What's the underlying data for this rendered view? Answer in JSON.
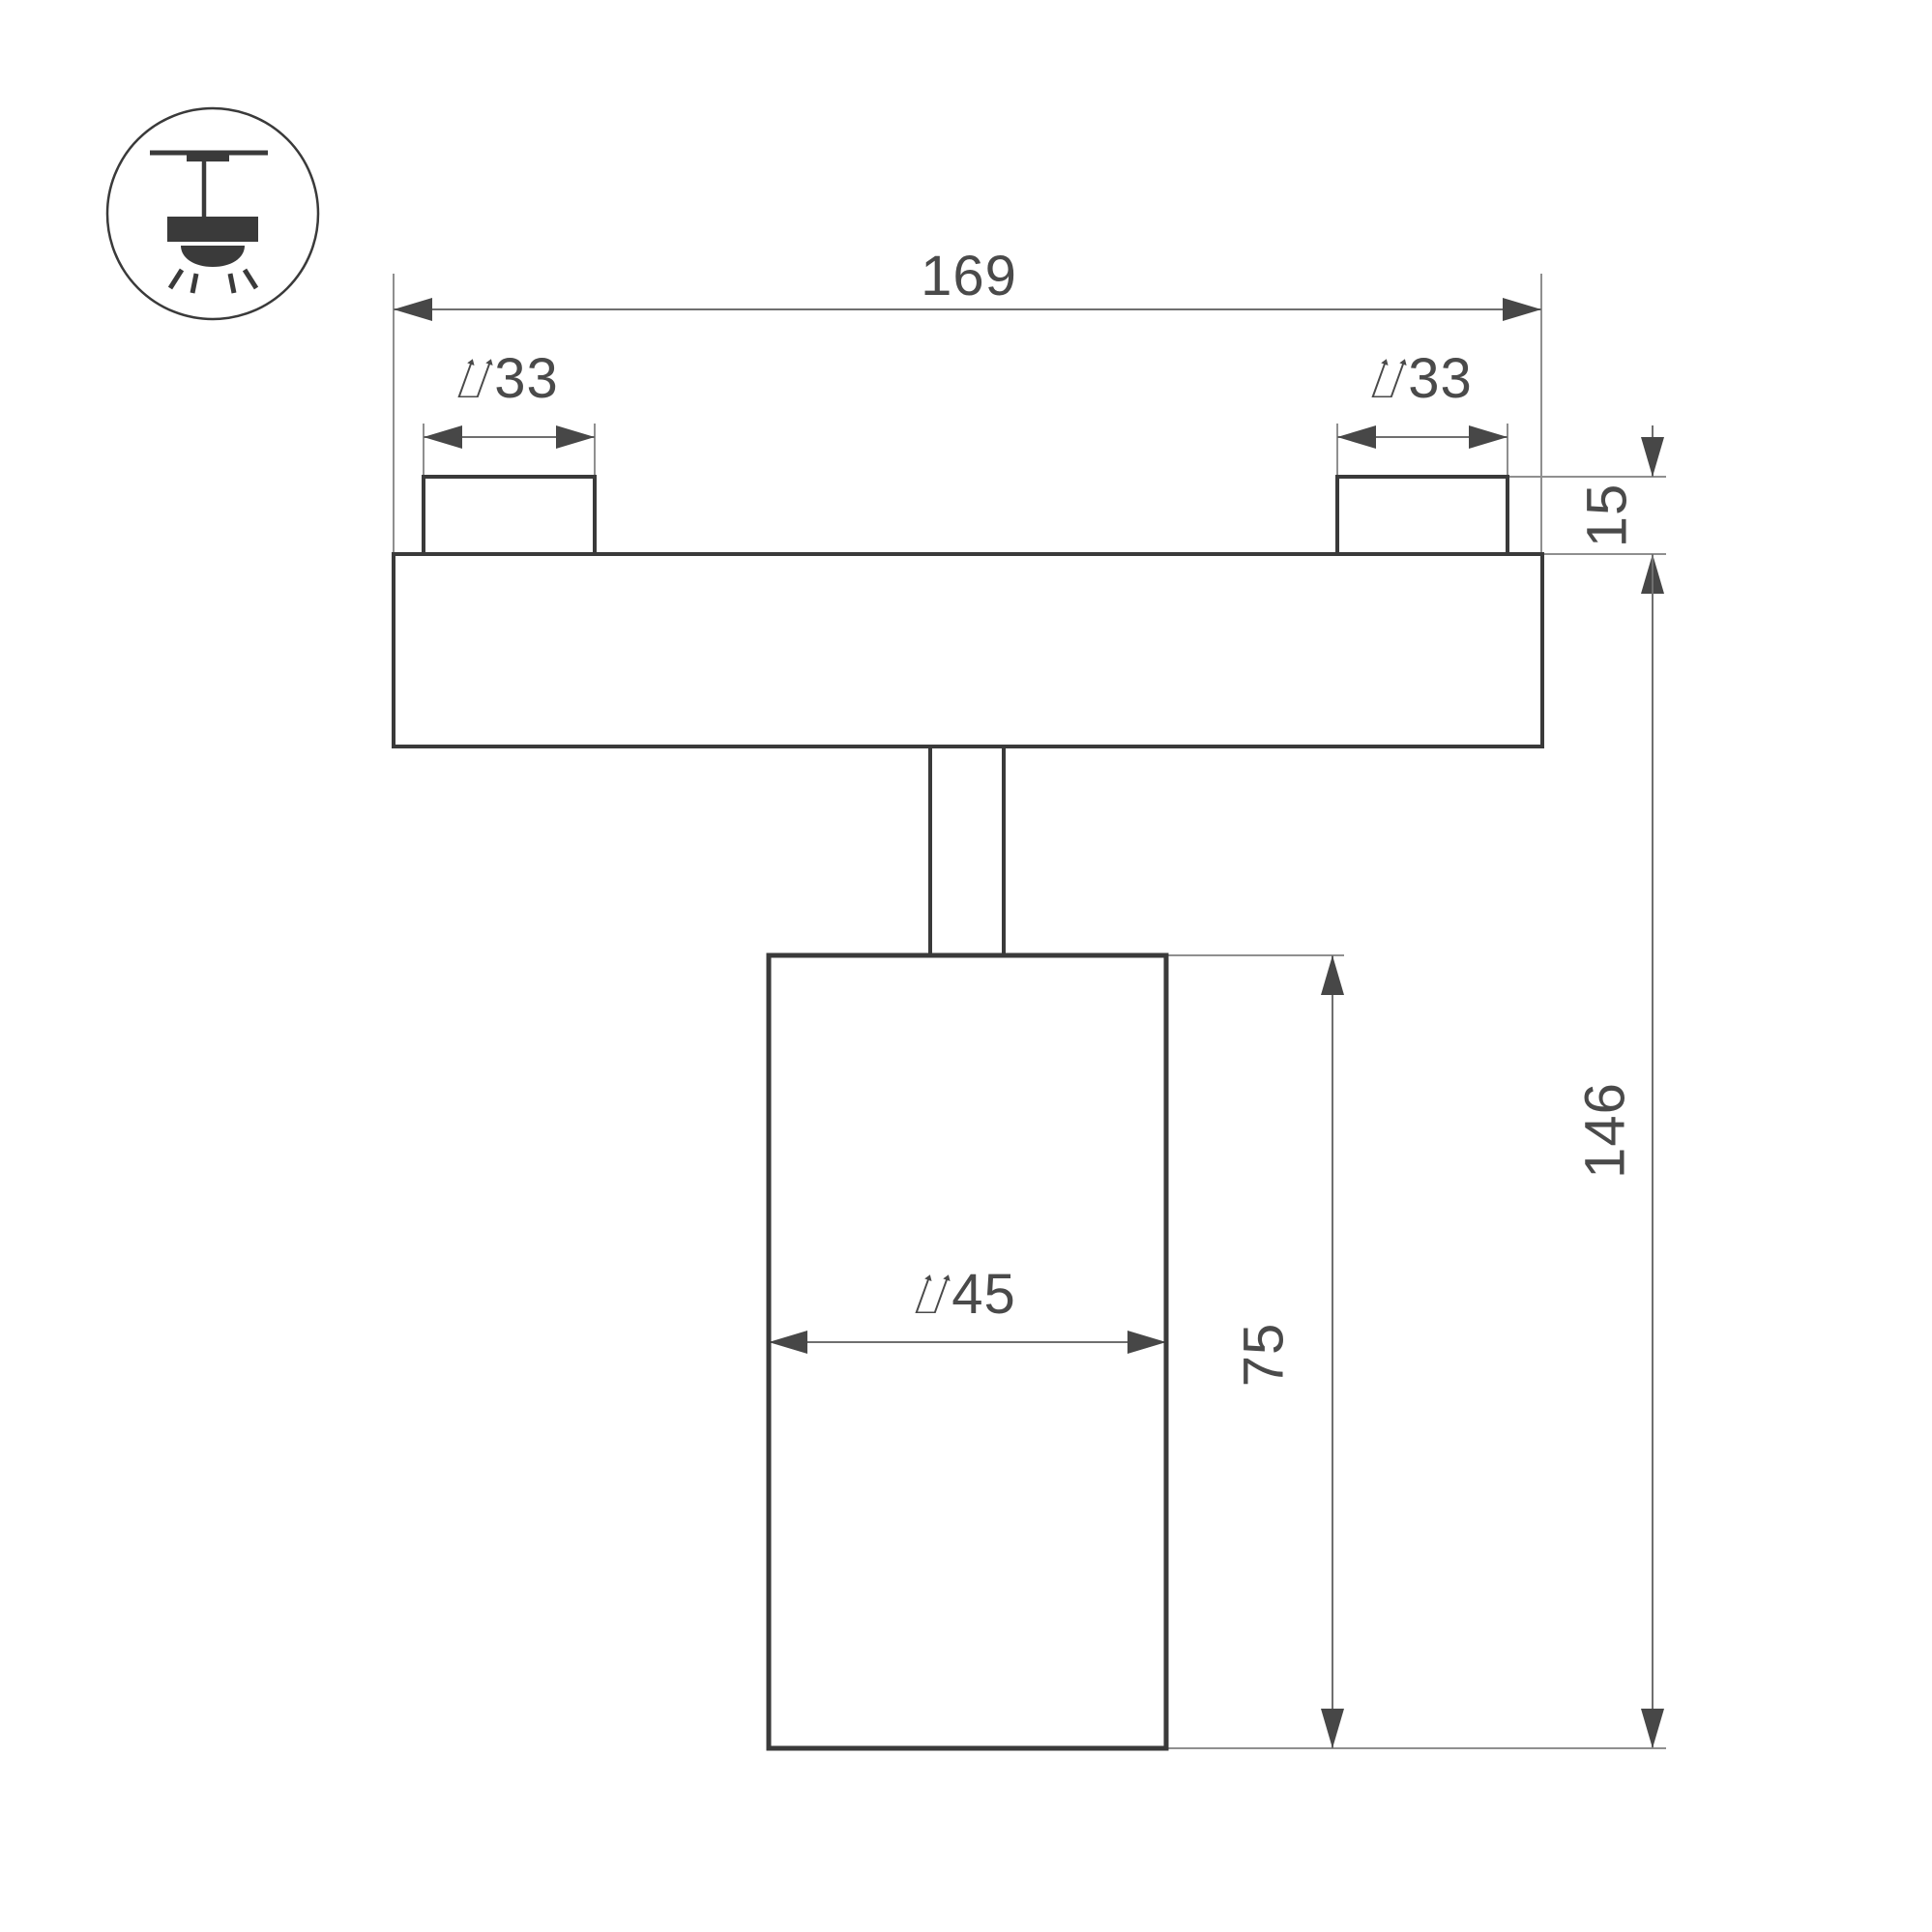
{
  "drawing": {
    "kind": "technical-dimension-drawing",
    "product": "track-mounted spotlight side view",
    "icon": {
      "name": "ceiling-track-pendant-light-icon",
      "description": "circle pictogram: ceiling line with track adapter, stem, lamp body, light dome with rays"
    },
    "dims": {
      "overall_width": {
        "label": "169",
        "value": 169
      },
      "left_connector_diameter": {
        "label": "⌰33",
        "value": 33
      },
      "right_connector_diameter": {
        "label": "⌰33",
        "value": 33
      },
      "connector_height": {
        "label": "15",
        "value": 15
      },
      "body_diameter": {
        "label": "⌰45",
        "value": 45
      },
      "body_height": {
        "label": "75",
        "value": 75
      },
      "overall_height": {
        "label": "146",
        "value": 146
      }
    },
    "colors": {
      "outline": "#3a3a3a",
      "ext": "#8f8f8f",
      "dim": "#6f6f6f",
      "arrow": "#474747",
      "text": "#4a4a4a",
      "bg": "#ffffff"
    }
  }
}
